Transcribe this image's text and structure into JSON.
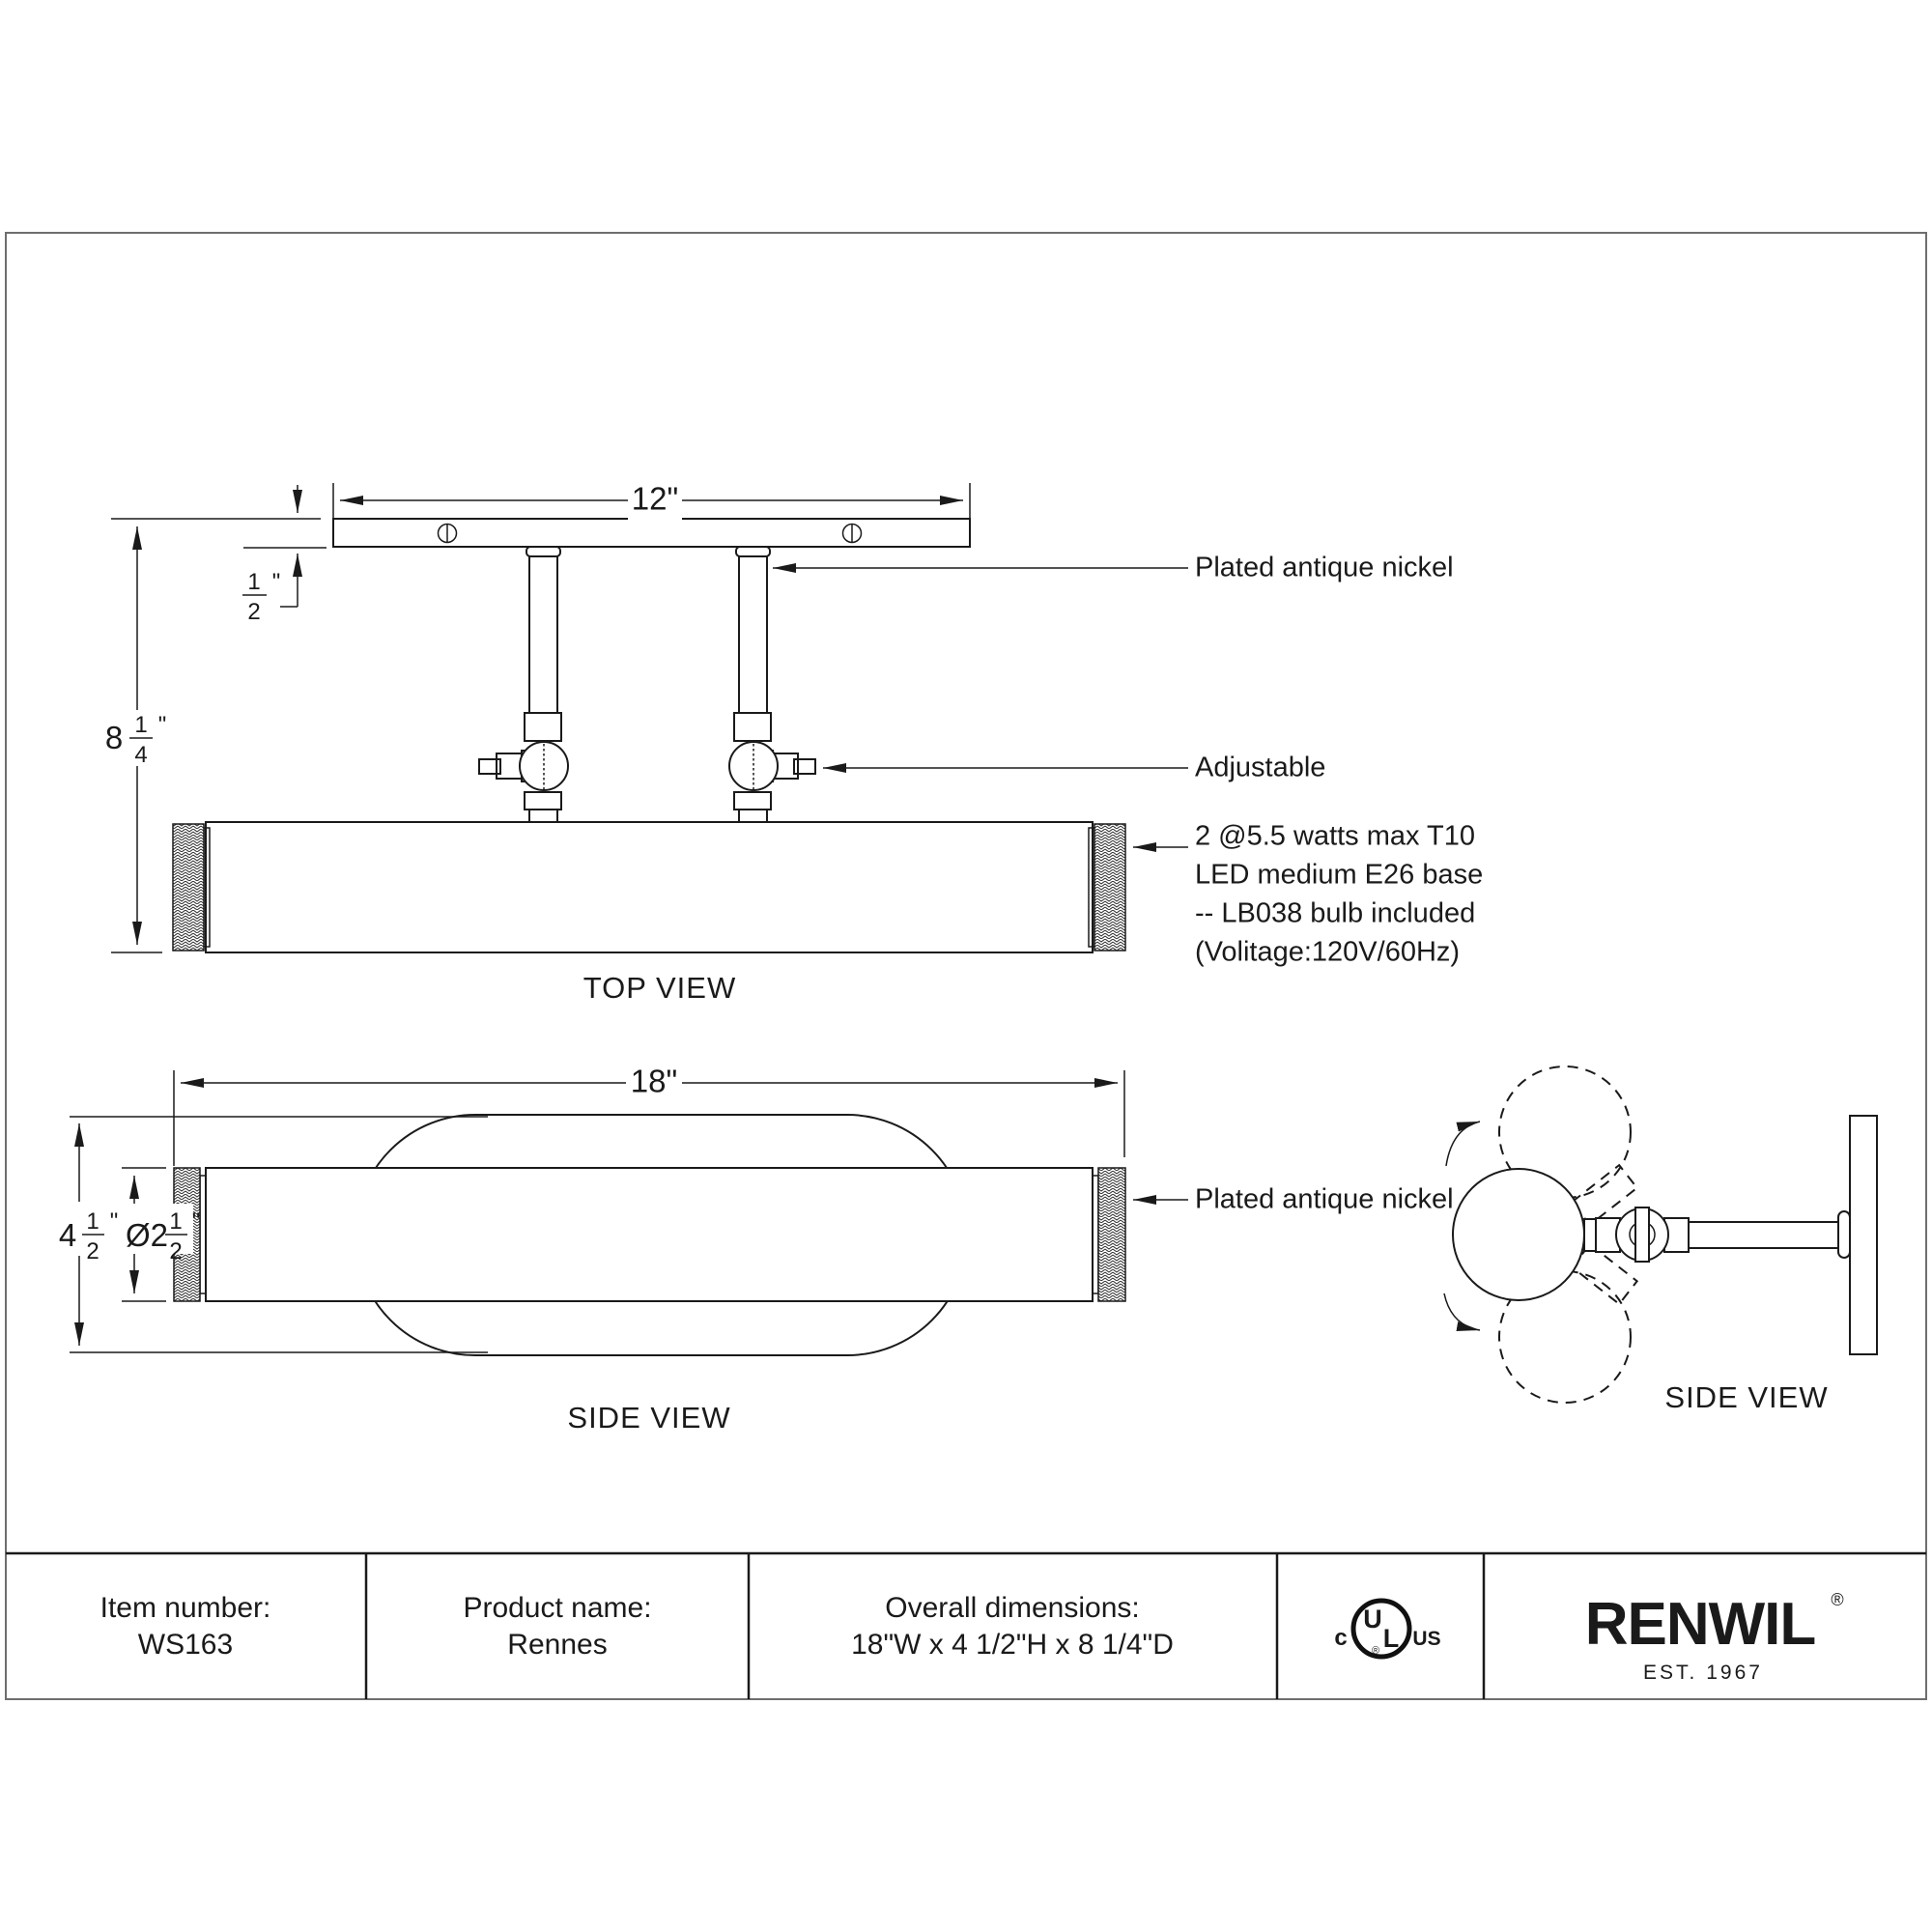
{
  "views": {
    "top": {
      "label": "TOP VIEW",
      "width_dim": "12\"",
      "height_dim": {
        "whole": "8",
        "num": "1",
        "den": "4",
        "unit": "\""
      },
      "thickness_dim": {
        "num": "1",
        "den": "2",
        "unit": "\""
      }
    },
    "side_left": {
      "label": "SIDE VIEW",
      "width_dim": "18\"",
      "height_dim": {
        "whole": "4",
        "num": "1",
        "den": "2",
        "unit": "\""
      },
      "diameter_dim": {
        "whole": "Ø2",
        "num": "1",
        "den": "2",
        "unit": "\""
      }
    },
    "side_right": {
      "label": "SIDE VIEW"
    }
  },
  "annotations": {
    "finish_top": "Plated antique nickel",
    "adjustable": "Adjustable",
    "bulb_spec": [
      "2 @5.5 watts max T10",
      "LED medium E26 base",
      "-- LB038 bulb included",
      "(Volitage:120V/60Hz)"
    ],
    "finish_side": "Plated antique nickel"
  },
  "title_block": {
    "item_number_label": "Item number:",
    "item_number": "WS163",
    "product_name_label": "Product name:",
    "product_name": "Rennes",
    "dimensions_label": "Overall dimensions:",
    "dimensions": "18\"W x 4 1/2\"H x 8 1/4\"D",
    "certification": {
      "c": "c",
      "u": "U",
      "l": "L",
      "us": "US",
      "reg": "®"
    },
    "brand": {
      "name": "RENWIL",
      "reg": "®",
      "est": "EST. 1967"
    }
  },
  "colors": {
    "line": "#1a1a1a",
    "border": "#6e6e6e",
    "background": "#ffffff"
  }
}
